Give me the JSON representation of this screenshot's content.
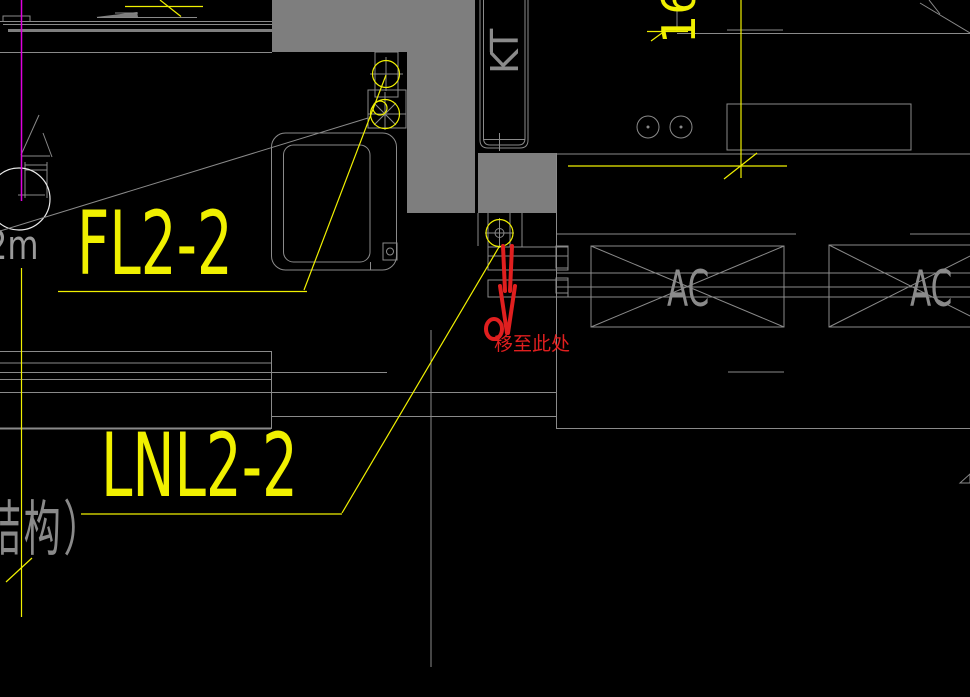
{
  "cad": {
    "labels": {
      "fan_label_1": "FL2-2",
      "fan_label_2": "LNL2-2",
      "duct_label": "KT",
      "ac_unit_1": "AC",
      "ac_unit_2": "AC",
      "number_16": "16",
      "dimension_2m": "2m",
      "structure_text": "结构）"
    },
    "annotation": {
      "move_here": "移至此处"
    },
    "colors": {
      "background": "#000000",
      "line_gray": "#8a8a8a",
      "fill_gray": "#7e7e7e",
      "circle_white": "#eaeaea",
      "accent_yellow": "#f0f000",
      "accent_magenta": "#e000e0",
      "annotation_red": "#e01f1f"
    }
  }
}
